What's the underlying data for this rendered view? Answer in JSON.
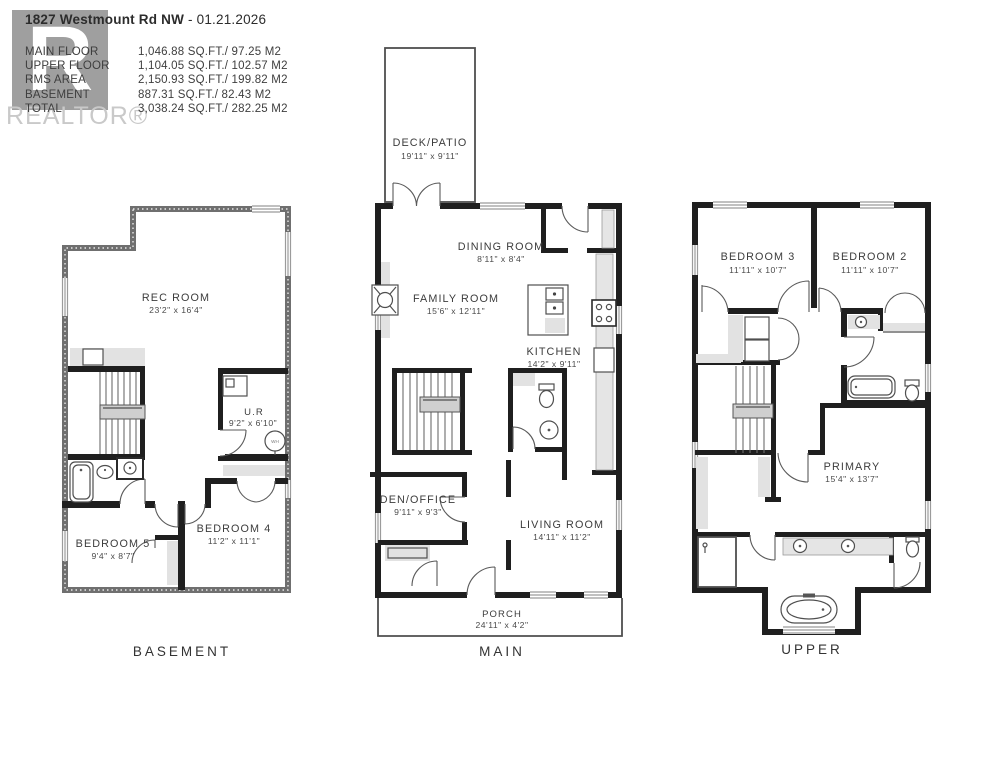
{
  "header": {
    "address": "1827 Westmount Rd NW",
    "date": "- 01.21.2026",
    "areas": [
      {
        "label": "MAIN FLOOR",
        "value": "1,046.88 SQ.FT./ 97.25 M2"
      },
      {
        "label": "UPPER FLOOR",
        "value": "1,104.05 SQ.FT./ 102.57 M2"
      },
      {
        "label": "RMS AREA",
        "value": "2,150.93 SQ.FT./ 199.82 M2"
      },
      {
        "label": "BASEMENT",
        "value": "887.31 SQ.FT./ 82.43 M2"
      },
      {
        "label": "TOTAL",
        "value": "3,038.24 SQ.FT./ 282.25 M2"
      }
    ],
    "watermark": {
      "logo_letter": "R",
      "brand": "REALTOR®"
    }
  },
  "floors": {
    "basement": {
      "label": "BASEMENT",
      "rooms": {
        "rec": {
          "name": "REC ROOM",
          "dims": "23'2\" x 16'4\""
        },
        "ur": {
          "name": "U.R",
          "dims": "9'2\" x 6'10\""
        },
        "bed5": {
          "name": "BEDROOM 5",
          "dims": "9'4\" x 8'7\""
        },
        "bed4": {
          "name": "BEDROOM 4",
          "dims": "11'2\" x 11'1\""
        }
      },
      "fixtures": {
        "water_heater": "WH"
      }
    },
    "main": {
      "label": "MAIN",
      "rooms": {
        "deck": {
          "name": "DECK/PATIO",
          "dims": "19'11\" x 9'11\""
        },
        "dining": {
          "name": "DINING ROOM",
          "dims": "8'11\" x 8'4\""
        },
        "family": {
          "name": "FAMILY ROOM",
          "dims": "15'6\" x 12'11\""
        },
        "kitchen": {
          "name": "KITCHEN",
          "dims": "14'2\" x 9'11\""
        },
        "den": {
          "name": "DEN/OFFICE",
          "dims": "9'11\" x 9'3\""
        },
        "living": {
          "name": "LIVING ROOM",
          "dims": "14'11\" x 11'2\""
        },
        "porch": {
          "name": "PORCH",
          "dims": "24'11\" x 4'2\""
        }
      }
    },
    "upper": {
      "label": "UPPER",
      "rooms": {
        "bed3": {
          "name": "BEDROOM 3",
          "dims": "11'11\" x 10'7\""
        },
        "bed2": {
          "name": "BEDROOM 2",
          "dims": "11'11\" x 10'7\""
        },
        "primary": {
          "name": "PRIMARY",
          "dims": "15'4\" x 13'7\""
        }
      }
    }
  }
}
